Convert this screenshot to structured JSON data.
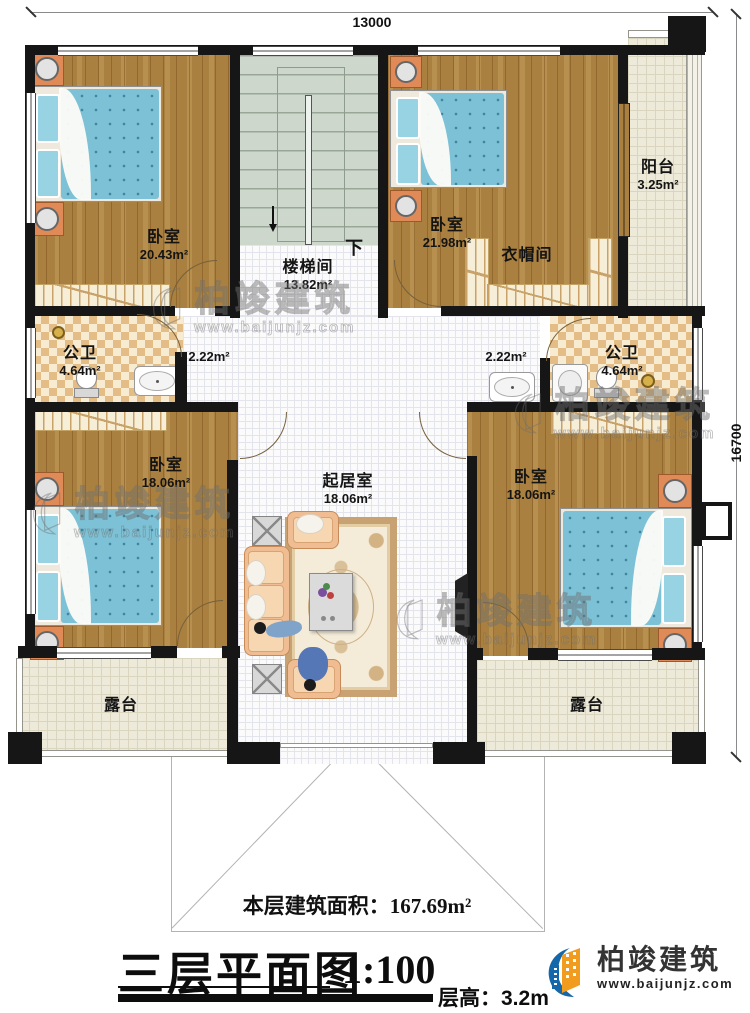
{
  "dimensions": {
    "top": "13000",
    "right": "16700"
  },
  "rooms": {
    "bedroom_tl": {
      "name": "卧室",
      "area": "20.43m²"
    },
    "bedroom_tr": {
      "name": "卧室",
      "area": "21.98m²"
    },
    "bedroom_bl": {
      "name": "卧室",
      "area": "18.06m²"
    },
    "bedroom_br": {
      "name": "卧室",
      "area": "18.06m²"
    },
    "living": {
      "name": "起居室",
      "area": "18.06m²"
    },
    "stairwell": {
      "name": "楼梯间",
      "area": "13.82m²",
      "down": "下"
    },
    "cloakroom": {
      "name": "衣帽间"
    },
    "balcony": {
      "name": "阳台",
      "area": "3.25m²"
    },
    "bath_left": {
      "name": "公卫",
      "area": "4.64m²"
    },
    "bath_right": {
      "name": "公卫",
      "area": "4.64m²"
    },
    "hall_left": {
      "area": "2.22m²"
    },
    "hall_right": {
      "area": "2.22m²"
    },
    "terrace_left": {
      "name": "露台"
    },
    "terrace_right": {
      "name": "露台"
    }
  },
  "footer": {
    "floor_area_label": "本层建筑面积：",
    "floor_area_value": "167.69m²",
    "plan_title": "三层平面图",
    "plan_scale": "1:100",
    "floor_height_label": "层高：",
    "floor_height_value": "3.2m"
  },
  "brand": {
    "name": "柏竣建筑",
    "website": "www.baijunjz.com"
  },
  "colors": {
    "wall": "#161616",
    "wood_floor": "#a9803f",
    "bed_fabric": "#7cc1d6",
    "logo_blue": "#1467a8",
    "logo_orange": "#f29c1f"
  }
}
